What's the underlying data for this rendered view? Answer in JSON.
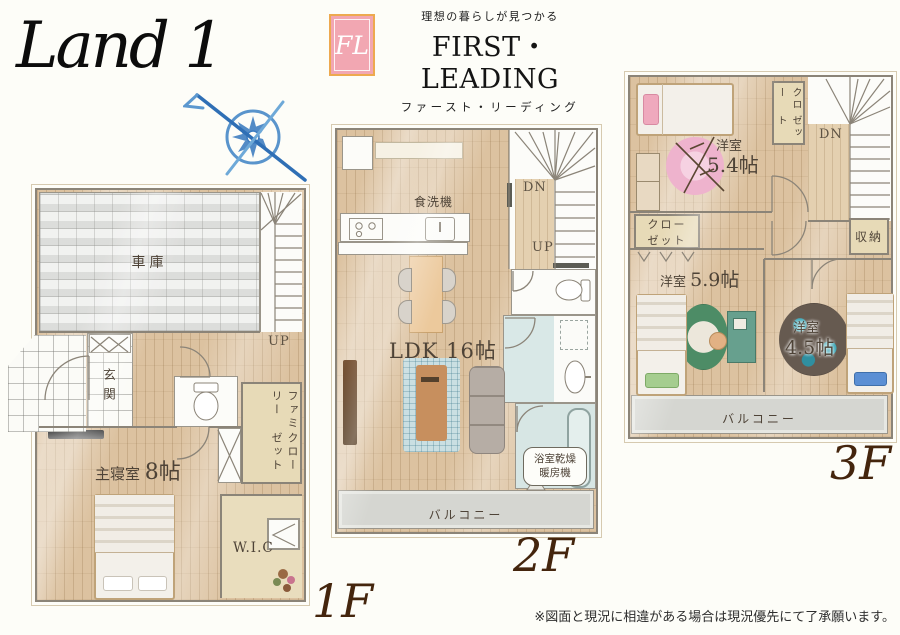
{
  "header": {
    "logo_script": "Land 1",
    "brand_mark": "FL",
    "brand_tagline": "理想の暮らしが見つかる",
    "brand_name": "FIRST・LEADING",
    "brand_kana": "ファースト・リーディング"
  },
  "floors": {
    "f1": {
      "label": "1F",
      "garage": "車庫",
      "up": "UP",
      "entrance": "玄関",
      "family_closet_col1": "ファミリー",
      "family_closet_col2": "クローゼット",
      "master_name": "主寝室",
      "master_size": "8帖",
      "wic": "W.I.C"
    },
    "f2": {
      "label": "2F",
      "dishwasher": "食洗機",
      "dn": "DN",
      "up": "UP",
      "ldk": "LDK 16帖",
      "bath_dryer_line1": "浴室乾燥",
      "bath_dryer_line2": "暖房機",
      "balcony": "バルコニー"
    },
    "f3": {
      "label": "3F",
      "room54_name": "洋室",
      "room54_size": "5.4帖",
      "closet_top_col1": "クロー",
      "closet_top_col2": "ゼット",
      "dn": "DN",
      "closet_left_line1": "クロー",
      "closet_left_line2": "ゼット",
      "room59_name": "洋室",
      "room59_size": "5.9帖",
      "room45_name": "洋室",
      "room45_size": "4.5帖",
      "storage": "収納",
      "balcony": "バルコニー"
    }
  },
  "footer": {
    "disclaimer": "※図面と現況に相違がある場合は現況優先にて了承願います。"
  },
  "colors": {
    "brand_pink": "#f2a7b2",
    "brand_orange": "#eda94f",
    "compass_blue": "#3c7cc0",
    "wood_floor": "#dcc2a0",
    "floor_label_brown": "#44250d"
  }
}
